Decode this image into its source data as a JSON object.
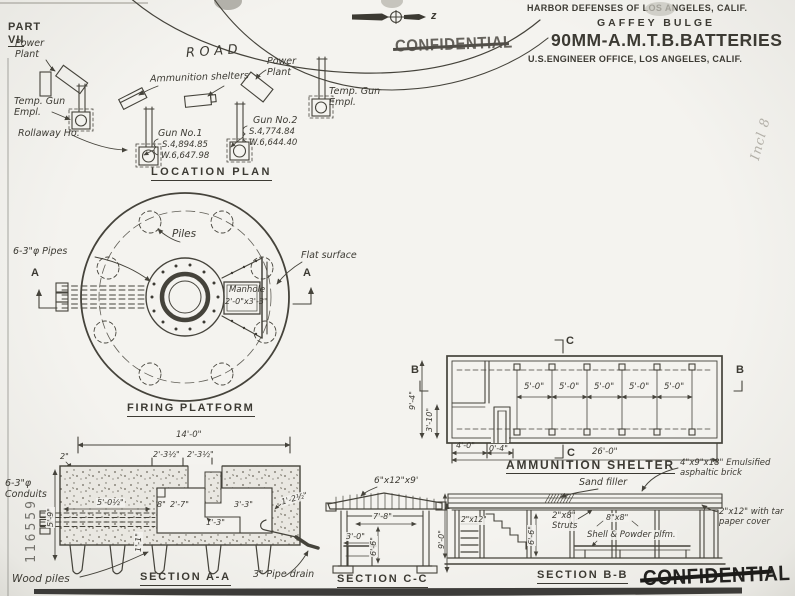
{
  "page": {
    "part_label": "PART",
    "part_number": "VII"
  },
  "header": {
    "line1": "HARBOR DEFENSES OF LOS ANGELES, CALIF.",
    "line2": "GAFFEY BULGE",
    "line3": "90MM-A.M.T.B.BATTERIES",
    "line4": "U.S.ENGINEER OFFICE, LOS ANGELES, CALIF."
  },
  "compass": {
    "axis_label": "z"
  },
  "stamps": {
    "confidential": "CONFIDENTIAL",
    "serial_number": "116559",
    "handwritten_note": "Incl 8"
  },
  "location_plan": {
    "title": "LOCATION PLAN",
    "road": "ROAD",
    "power_plant_left": "Power\nPlant",
    "power_plant_right": "Power\nPlant",
    "temp_gun_left": "Temp. Gun\nEmpl.",
    "temp_gun_right": "Temp. Gun\nEmpl.",
    "rollaway": "Rollaway Ho.",
    "ammunition_shelters": "Ammunition shelters",
    "gun1": {
      "name": "Gun No.1",
      "s_coord": "S.4,894.85",
      "w_coord": "W.6,647.98"
    },
    "gun2": {
      "name": "Gun No.2",
      "s_coord": "S.4,774.84",
      "w_coord": "W.6,644.40"
    }
  },
  "firing_platform": {
    "title": "FIRING PLATFORM",
    "pipes_label": "6-3\"φ Pipes",
    "piles_label": "Piles",
    "flat_surface": "Flat surface",
    "manhole_line1": "Manhole",
    "manhole_line2": "2'-0\"x3'-3\"",
    "section_marker": "A"
  },
  "section_aa": {
    "title": "SECTION A-A",
    "dim_width": "14'-0\"",
    "dim_left_half": "2'-3½\"",
    "dim_right_half": "2'-3½\"",
    "dim_edge": "2\"",
    "dim_slab": "5'-0½\"",
    "dim_ledge": "8\"",
    "dim_pit_left": "2'-7\"",
    "dim_pit_right": "3'-3\"",
    "dim_step": "1'-3\"",
    "dim_wall": "1'-2½\"",
    "dim_base": "1'-1\"",
    "dim_depth": "5'-9\"",
    "conduits_label": "6-3\"φ\nConduits",
    "wood_piles_label": "Wood piles",
    "pipe_drain_label": "3\" Pipe drain"
  },
  "section_cc": {
    "title": "SECTION C-C",
    "beam_label": "6\"x12\"x9'",
    "dim_width": "7'-8\"",
    "dim_bench": "3'-0\"",
    "dim_interior": "6'-6\"",
    "dim_height": "9'-0\""
  },
  "ammunition_shelter": {
    "title": "AMMUNITION SHELTER",
    "bays": [
      "5'-0\"",
      "5'-0\"",
      "5'-0\"",
      "5'-0\"",
      "5'-0\""
    ],
    "dim_height": "9'-4\"",
    "dim_lower": "3'-10\"",
    "dim_entry": "4'-0\"",
    "dim_door": "0'-4\"",
    "dim_length": "26'-0\"",
    "mark_c": "C",
    "mark_b": "B",
    "sand_filler": "Sand filler"
  },
  "section_bb": {
    "title": "SECTION B-B",
    "shelf_label": "2\"x12\"",
    "dim_interior": "6'-6\"",
    "struts_label": "2\"x8\"\nStruts",
    "post_label": "8\"x8\"",
    "platform_label": "Shell & Powder plfm.",
    "brick_note": "4\"x9\"x18\" Emulsified\nasphaltic brick",
    "tar_note": "2\"x12\" with tar\npaper cover"
  }
}
